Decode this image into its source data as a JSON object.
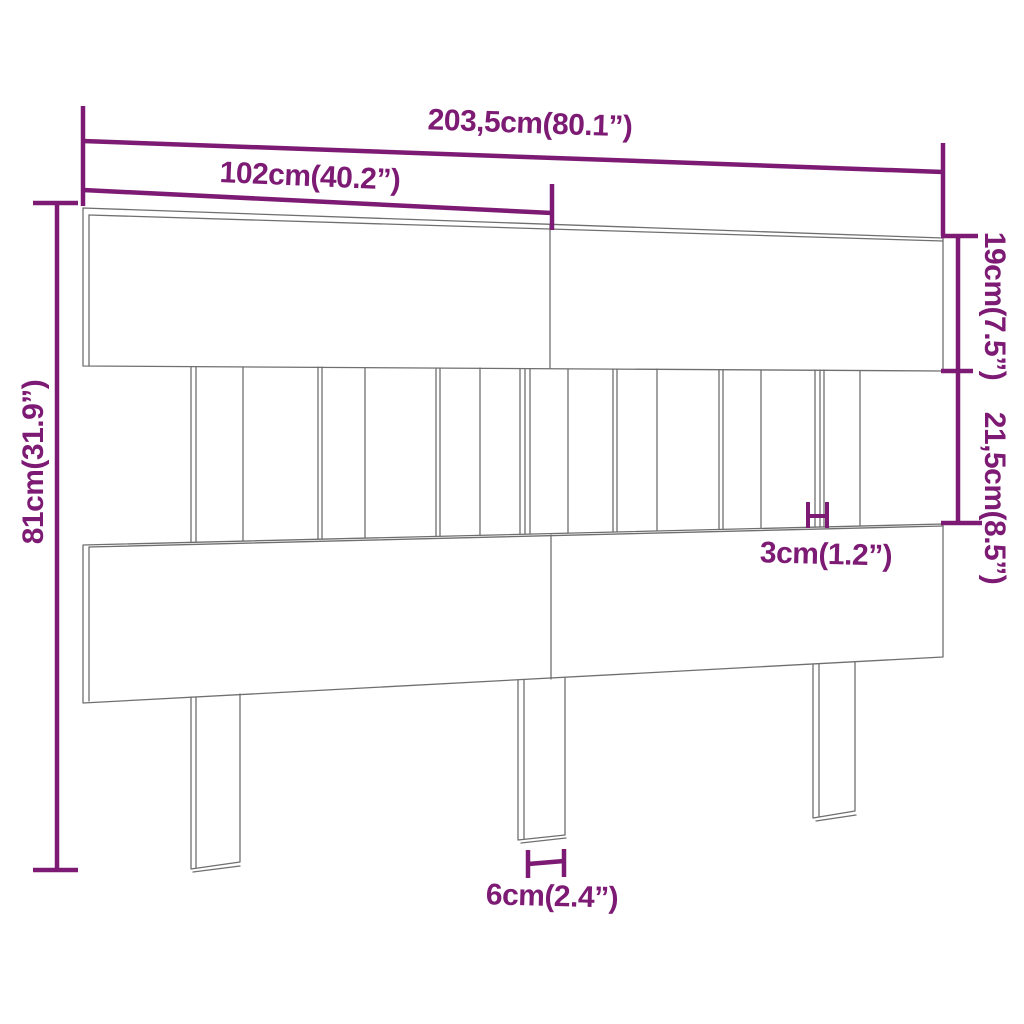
{
  "diagram": {
    "accent_color": "#7d1b74",
    "outline_color": "#6f6f6f",
    "background_color": "#ffffff",
    "labels": {
      "total_width": "203,5cm(80.1”)",
      "panel_width": "102cm(40.2”)",
      "total_height": "81cm(31.9”)",
      "top_board_height": "19cm(7.5”)",
      "slat_section_height": "21,5cm(8.5”)",
      "slat_width": "3cm(1.2”)",
      "leg_width": "6cm(2.4”)"
    }
  }
}
